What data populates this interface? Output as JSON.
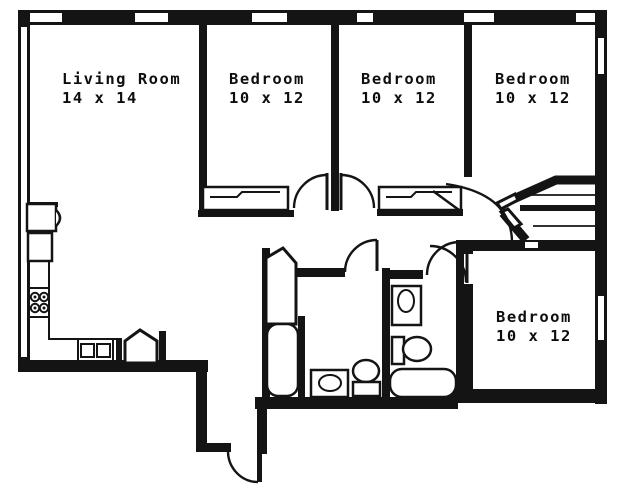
{
  "document": {
    "type": "floor-plan"
  },
  "rooms": [
    {
      "name": "Living Room",
      "dimensions": "14 x 14"
    },
    {
      "name": "Bedroom",
      "dimensions": "10 x 12"
    },
    {
      "name": "Bedroom",
      "dimensions": "10 x 12"
    },
    {
      "name": "Bedroom",
      "dimensions": "10 x 12"
    },
    {
      "name": "Bedroom",
      "dimensions": "10 x 12"
    }
  ],
  "unlabeled_spaces": [
    "kitchen",
    "dining-area",
    "hallway",
    "bathroom-1",
    "bathroom-2",
    "entry-vestibule"
  ],
  "fixtures": {
    "kitchen": [
      "refrigerator",
      "base-counter",
      "range-4-burners",
      "double-sink",
      "pantry-angled-door"
    ],
    "bathroom_1": [
      "angled-closet-door",
      "bathtub-vertical",
      "vanity-sink",
      "toilet"
    ],
    "bathroom_2": [
      "vanity-sink",
      "toilet",
      "bathtub-horizontal"
    ],
    "closets": [
      "bedroom-1-closet",
      "bedroom-2-closet",
      "hall-linen-closet-upper",
      "hall-linen-closet-lower"
    ]
  },
  "openings": {
    "exterior_door_count": 1,
    "interior_door_swings": 7,
    "window_slits_top_wall": 6,
    "window_slits_right_wall": 2
  },
  "colors": {
    "wall": "#141414",
    "background": "#ffffff"
  }
}
